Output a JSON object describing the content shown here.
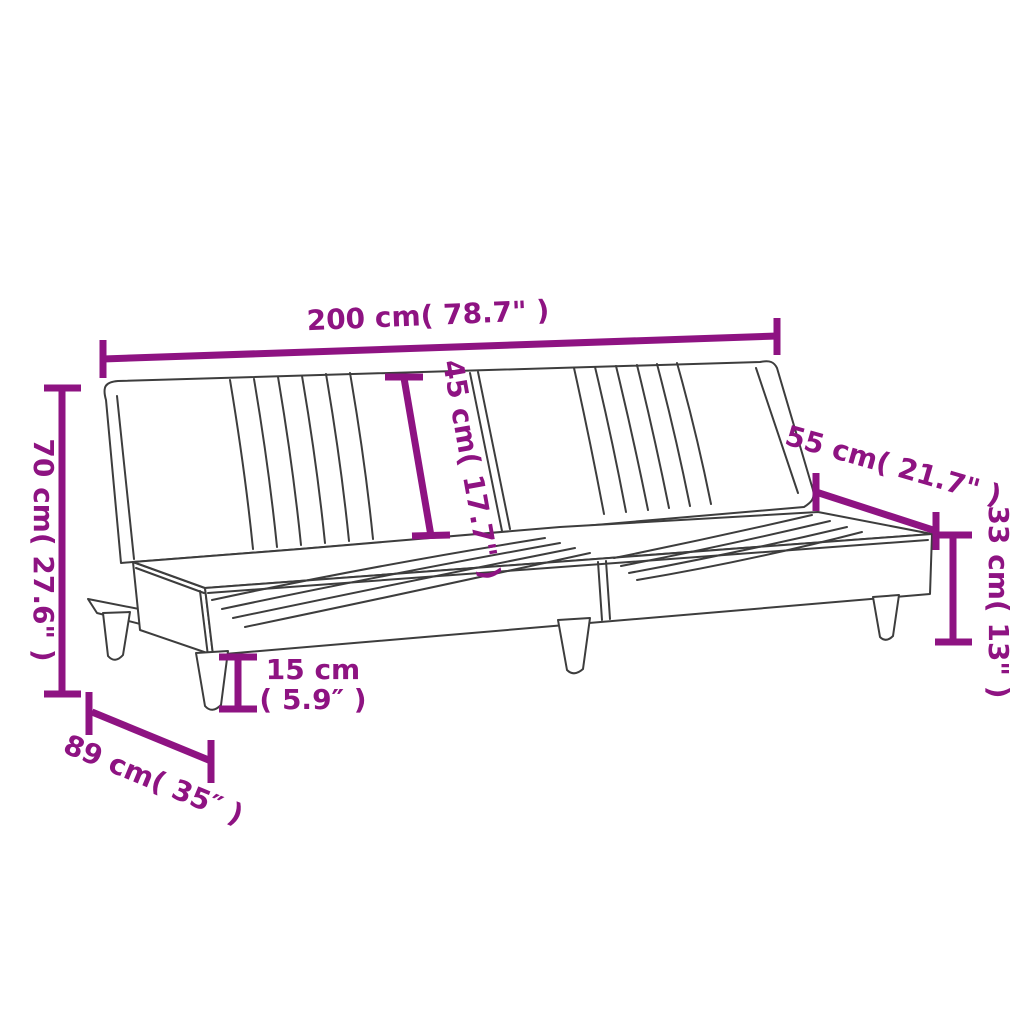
{
  "diagram": {
    "subject": "sofa-bed-dimension-drawing",
    "accent_color": "#8E1382",
    "line_color": "#3D3D3D",
    "labels": {
      "width": "200 cm( 78.7\" )",
      "backrest": "45 cm( 17.7\" )",
      "back_depth": "55 cm( 21.7\" )",
      "height": "70 cm( 27.6\" )",
      "seat_height": "33 cm( 13\" )",
      "leg_height_cm": "15 cm",
      "leg_height_in": "( 5.9″ )",
      "depth": "89 cm( 35″ )"
    }
  }
}
